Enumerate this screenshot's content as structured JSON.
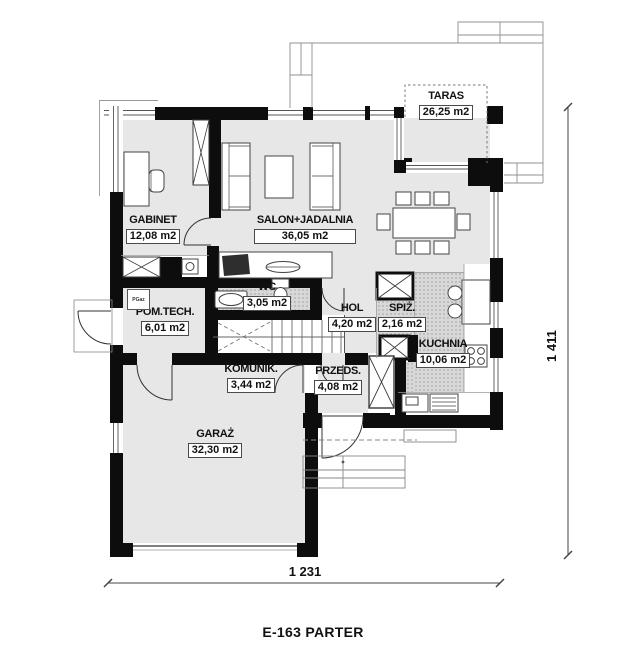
{
  "title": "E-163 PARTER",
  "dimensions": {
    "width_label": "1 231",
    "height_label": "1 411"
  },
  "annotations": {
    "gas_meter_label": "PGaz"
  },
  "rooms": [
    {
      "id": "gabinet",
      "name": "GABINET",
      "area": "12,08 m2"
    },
    {
      "id": "salon",
      "name": "SALON+JADALNIA",
      "area": "36,05 m2"
    },
    {
      "id": "taras",
      "name": "TARAS",
      "area": "26,25 m2"
    },
    {
      "id": "pomtech",
      "name": "POM.TECH.",
      "area": "6,01 m2"
    },
    {
      "id": "wc",
      "name": "WC",
      "area": "3,05 m2"
    },
    {
      "id": "hol",
      "name": "HOL",
      "area": "4,20 m2"
    },
    {
      "id": "spiz",
      "name": "SPIŻ.",
      "area": "2,16 m2"
    },
    {
      "id": "kuchnia",
      "name": "KUCHNIA",
      "area": "10,06 m2"
    },
    {
      "id": "komunik",
      "name": "KOMUNIK.",
      "area": "3,44 m2"
    },
    {
      "id": "przeds",
      "name": "PRZEDS.",
      "area": "4,08 m2"
    },
    {
      "id": "garaz",
      "name": "GARAŻ",
      "area": "32,30 m2"
    }
  ],
  "colors": {
    "wall": "#0d0d0d",
    "floor_light": "#e7e7e7",
    "floor_dotted": "#d8d8d8",
    "line_dark": "#333333",
    "line_light": "#909090"
  }
}
